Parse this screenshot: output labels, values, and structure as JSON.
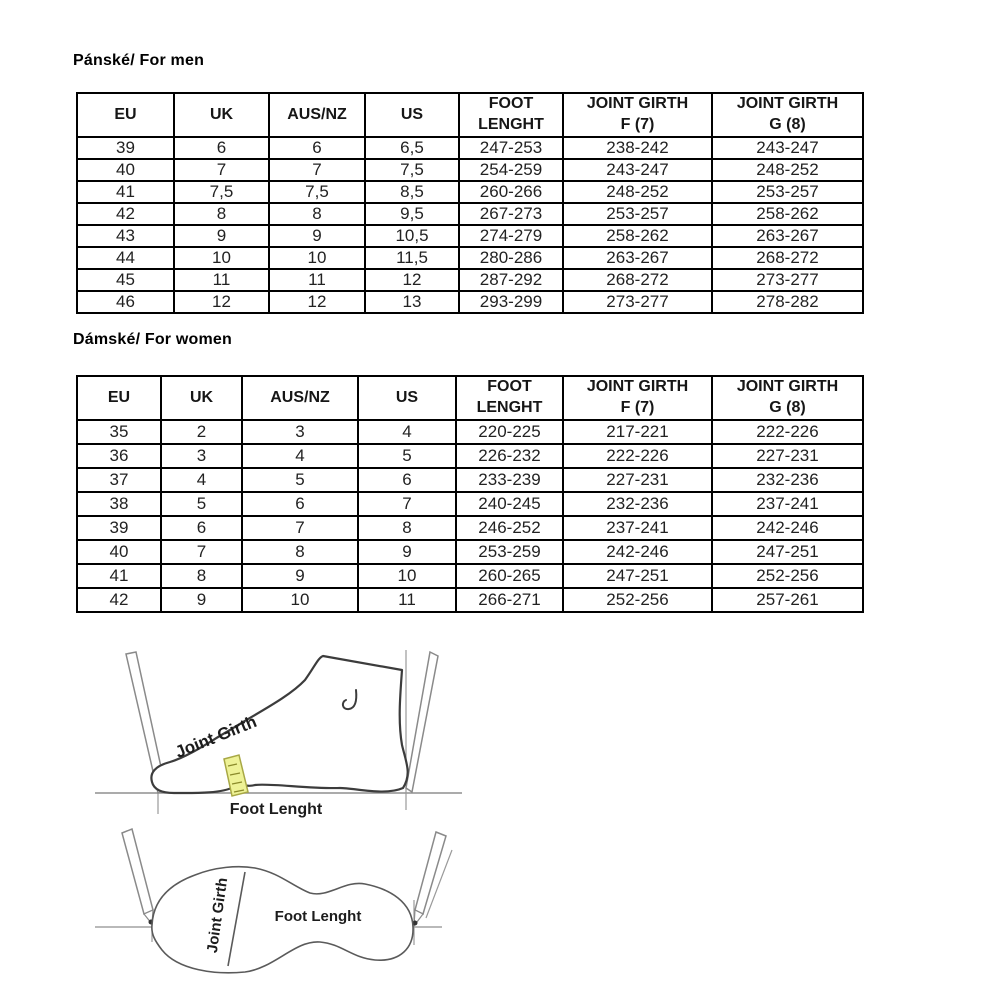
{
  "sections": {
    "men": {
      "title": "Pánské/ For men",
      "headers": [
        "EU",
        "UK",
        "AUS/NZ",
        "US",
        "FOOT\nLENGHT",
        "JOINT GIRTH\nF (7)",
        "JOINT GIRTH\nG (8)"
      ],
      "rows": [
        [
          "39",
          "6",
          "6",
          "6,5",
          "247-253",
          "238-242",
          "243-247"
        ],
        [
          "40",
          "7",
          "7",
          "7,5",
          "254-259",
          "243-247",
          "248-252"
        ],
        [
          "41",
          "7,5",
          "7,5",
          "8,5",
          "260-266",
          "248-252",
          "253-257"
        ],
        [
          "42",
          "8",
          "8",
          "9,5",
          "267-273",
          "253-257",
          "258-262"
        ],
        [
          "43",
          "9",
          "9",
          "10,5",
          "274-279",
          "258-262",
          "263-267"
        ],
        [
          "44",
          "10",
          "10",
          "11,5",
          "280-286",
          "263-267",
          "268-272"
        ],
        [
          "45",
          "11",
          "11",
          "12",
          "287-292",
          "268-272",
          "273-277"
        ],
        [
          "46",
          "12",
          "12",
          "13",
          "293-299",
          "273-277",
          "278-282"
        ]
      ]
    },
    "women": {
      "title": "Dámské/ For women",
      "headers": [
        "EU",
        "UK",
        "AUS/NZ",
        "US",
        "FOOT\nLENGHT",
        "JOINT GIRTH\nF (7)",
        "JOINT GIRTH\nG (8)"
      ],
      "rows": [
        [
          "35",
          "2",
          "3",
          "4",
          "220-225",
          "217-221",
          "222-226"
        ],
        [
          "36",
          "3",
          "4",
          "5",
          "226-232",
          "222-226",
          "227-231"
        ],
        [
          "37",
          "4",
          "5",
          "6",
          "233-239",
          "227-231",
          "232-236"
        ],
        [
          "38",
          "5",
          "6",
          "7",
          "240-245",
          "232-236",
          "237-241"
        ],
        [
          "39",
          "6",
          "7",
          "8",
          "246-252",
          "237-241",
          "242-246"
        ],
        [
          "40",
          "7",
          "8",
          "9",
          "253-259",
          "242-246",
          "247-251"
        ],
        [
          "41",
          "8",
          "9",
          "10",
          "260-265",
          "247-251",
          "252-256"
        ],
        [
          "42",
          "9",
          "10",
          "11",
          "266-271",
          "252-256",
          "257-261"
        ]
      ]
    }
  },
  "diagrams": {
    "tape_color": "#eef296",
    "tape_border_color": "#a8a845",
    "side_view": {
      "joint_girth_label": "Joint Girth",
      "foot_length_label": "Foot Lenght"
    },
    "sole_view": {
      "joint_girth_label": "Joint Girth",
      "foot_length_label": "Foot Lenght"
    }
  }
}
